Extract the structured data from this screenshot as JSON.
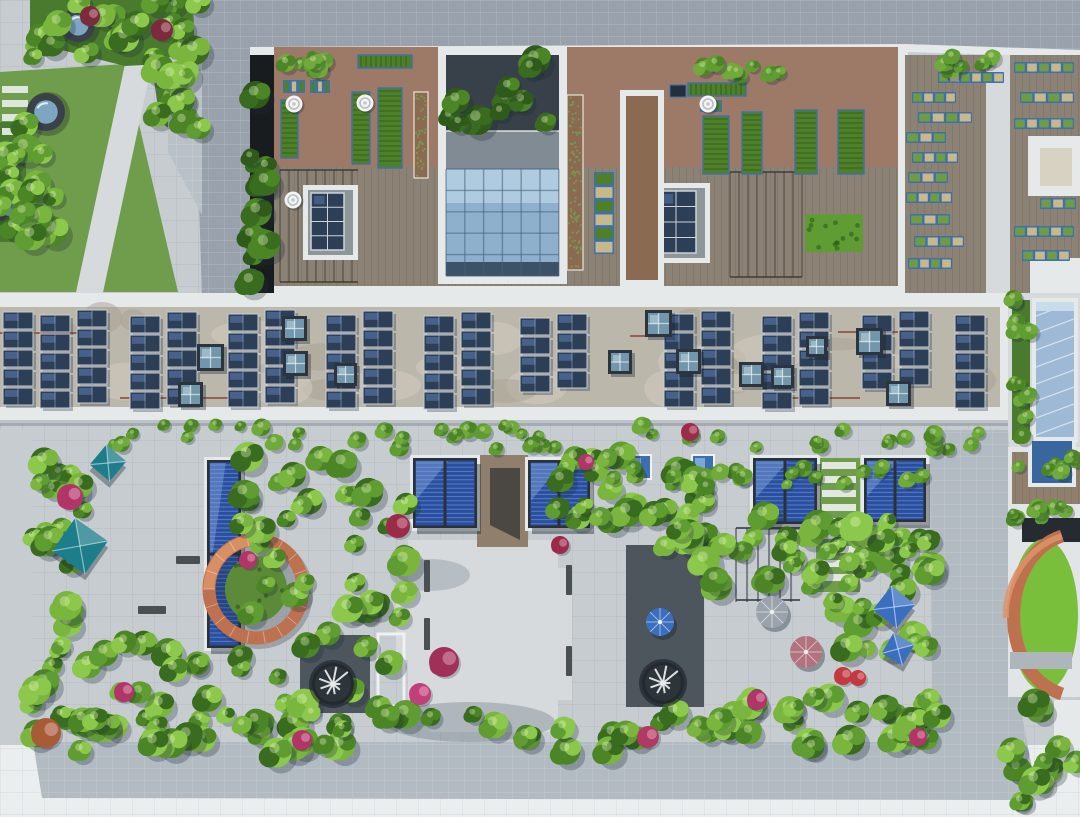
{
  "meta": {
    "title": "Aerial view of green rooftops",
    "description": "Top-down drone photograph of building rooftops with a lawn courtyard, rooftop vegetable farm, glass atrium, a long solar-panel roof and a lush landscaped roof garden with blue glass pergolas, copper ring walls, spiral stairs and umbrellas.",
    "image_type": "aerial-photograph"
  },
  "palette": {
    "paving": "#c7ccd1",
    "paving_light": "#d6dadd",
    "paving_white": "#ebeeef",
    "roof_gray": "#99a2ac",
    "roof_gray_light": "#b9c0c7",
    "roof_band": "#b2bac2",
    "parapet": "#e6e9ea",
    "lightwell_dark": "#191c1f",
    "pocket_dark": "#4d555d",
    "concrete": "#bcb7ab",
    "concrete_light": "#d2cdc0",
    "solar_dark": "#2d3e57",
    "solar_sheen": "#4a6590",
    "skylight_frame": "#2c343d",
    "skylight_glass": "#7296ab",
    "skylight_glass_light": "#a3c0cd",
    "atrium_dark": "#38414a",
    "slab_gray": "#818b94",
    "glass_blue": "#8fb0cd",
    "glass_blue_light": "#aecbe0",
    "glass_deep": "#3c5268",
    "pergola_blue": "#2b4f9f",
    "pergola_louver": "#6f94d8",
    "pergola_glare": "#87a8e0",
    "pergola_frame": "#2a3138",
    "lawn": "#6f9d4b",
    "grass_ring": "#5d8a38",
    "grass_bright": "#79bf3c",
    "foliage_base": "#4a7a2e",
    "soil_paver": "#9c7a67",
    "soil": "#8a6a50",
    "deck": "#8b8174",
    "deck_brown": "#8f7f6c",
    "planter_blue": "#3e6fae",
    "crop_green": "#4d8029",
    "pallet_tan": "#c9b98a",
    "copper": "#bd714e",
    "copper_light": "#dd9468",
    "teal_umbrella": "#1d7d8a",
    "blue_umbrella": "#3a6fc0",
    "mauve_umbrella": "#b2737f",
    "gray_umbrella": "#9aa3ab",
    "pipe_red": "#8f4a3c",
    "bench_dark": "#4a4f52",
    "shadow": "rgba(28,42,58,0.28)"
  },
  "scene": {
    "top_left": {
      "circular_skylights": [
        {
          "x": 78,
          "y": 25,
          "r": 17
        },
        {
          "x": 46,
          "y": 112,
          "r": 19
        },
        {
          "x": 10,
          "y": 205,
          "r": 18
        }
      ],
      "stepping_stones": {
        "x": 2,
        "y": 86,
        "w": 26,
        "h": 7,
        "gap": 14,
        "count": 5
      }
    },
    "farm": {
      "beds": [
        {
          "x": 358,
          "y": 55,
          "w": 54,
          "h": 13,
          "kind": "crop"
        },
        {
          "x": 283,
          "y": 80,
          "w": 22,
          "h": 13,
          "kind": "pallet"
        },
        {
          "x": 310,
          "y": 80,
          "w": 20,
          "h": 13,
          "kind": "pallet"
        },
        {
          "x": 281,
          "y": 100,
          "w": 17,
          "h": 58,
          "kind": "crop"
        },
        {
          "x": 352,
          "y": 92,
          "w": 18,
          "h": 72,
          "kind": "crop"
        },
        {
          "x": 378,
          "y": 88,
          "w": 24,
          "h": 80,
          "kind": "crop"
        },
        {
          "x": 414,
          "y": 92,
          "w": 14,
          "h": 86,
          "kind": "soil"
        },
        {
          "x": 567,
          "y": 95,
          "w": 16,
          "h": 175,
          "kind": "soil"
        },
        {
          "x": 594,
          "y": 172,
          "w": 20,
          "h": 82,
          "kind": "pallet"
        },
        {
          "x": 688,
          "y": 83,
          "w": 58,
          "h": 13,
          "kind": "crop"
        },
        {
          "x": 670,
          "y": 85,
          "w": 16,
          "h": 12,
          "kind": "dark"
        },
        {
          "x": 700,
          "y": 100,
          "w": 22,
          "h": 12,
          "kind": "pallet"
        },
        {
          "x": 703,
          "y": 116,
          "w": 26,
          "h": 58,
          "kind": "crop"
        },
        {
          "x": 742,
          "y": 112,
          "w": 20,
          "h": 62,
          "kind": "crop"
        },
        {
          "x": 795,
          "y": 110,
          "w": 22,
          "h": 64,
          "kind": "crop"
        },
        {
          "x": 838,
          "y": 110,
          "w": 26,
          "h": 64,
          "kind": "crop"
        },
        {
          "x": 805,
          "y": 214,
          "w": 58,
          "h": 38,
          "kind": "hedge"
        }
      ],
      "vents": [
        {
          "x": 294,
          "y": 104
        },
        {
          "x": 293,
          "y": 200
        },
        {
          "x": 365,
          "y": 103
        },
        {
          "x": 630,
          "y": 103
        },
        {
          "x": 708,
          "y": 104
        }
      ],
      "solar_units": [
        {
          "x": 303,
          "y": 185,
          "w": 55,
          "h": 75
        },
        {
          "x": 648,
          "y": 183,
          "w": 62,
          "h": 80
        }
      ],
      "trellis": [
        {
          "x": 280,
          "y": 170,
          "w": 78,
          "h": 112
        },
        {
          "x": 730,
          "y": 172,
          "w": 72,
          "h": 105
        }
      ]
    },
    "right_deck": {
      "planter_rows": [
        {
          "x": 938,
          "y": 72,
          "w": 66,
          "h": 11
        },
        {
          "x": 912,
          "y": 92,
          "w": 44,
          "h": 11
        },
        {
          "x": 918,
          "y": 112,
          "w": 54,
          "h": 11
        },
        {
          "x": 906,
          "y": 132,
          "w": 40,
          "h": 11
        },
        {
          "x": 912,
          "y": 152,
          "w": 46,
          "h": 11
        },
        {
          "x": 908,
          "y": 172,
          "w": 40,
          "h": 11
        },
        {
          "x": 906,
          "y": 192,
          "w": 46,
          "h": 11
        },
        {
          "x": 910,
          "y": 214,
          "w": 40,
          "h": 11
        },
        {
          "x": 914,
          "y": 236,
          "w": 50,
          "h": 11
        },
        {
          "x": 908,
          "y": 258,
          "w": 44,
          "h": 11
        },
        {
          "x": 1014,
          "y": 62,
          "w": 60,
          "h": 11
        },
        {
          "x": 1020,
          "y": 92,
          "w": 54,
          "h": 11
        },
        {
          "x": 1014,
          "y": 118,
          "w": 60,
          "h": 11
        },
        {
          "x": 1040,
          "y": 198,
          "w": 36,
          "h": 11
        },
        {
          "x": 1014,
          "y": 226,
          "w": 60,
          "h": 11
        },
        {
          "x": 1022,
          "y": 250,
          "w": 48,
          "h": 11
        }
      ]
    },
    "solar_roof": {
      "panel": {
        "w": 30,
        "h": 17,
        "gap": 2
      },
      "columns": [
        {
          "x": 3,
          "y": 312,
          "n": 5
        },
        {
          "x": 40,
          "y": 315,
          "n": 5
        },
        {
          "x": 77,
          "y": 310,
          "n": 5
        },
        {
          "x": 130,
          "y": 316,
          "n": 5
        },
        {
          "x": 167,
          "y": 312,
          "n": 5
        },
        {
          "x": 228,
          "y": 314,
          "n": 5
        },
        {
          "x": 265,
          "y": 310,
          "n": 5
        },
        {
          "x": 326,
          "y": 315,
          "n": 5
        },
        {
          "x": 363,
          "y": 311,
          "n": 5
        },
        {
          "x": 424,
          "y": 316,
          "n": 5
        },
        {
          "x": 461,
          "y": 312,
          "n": 5
        },
        {
          "x": 520,
          "y": 318,
          "n": 4
        },
        {
          "x": 557,
          "y": 314,
          "n": 4
        },
        {
          "x": 664,
          "y": 314,
          "n": 5
        },
        {
          "x": 701,
          "y": 311,
          "n": 5
        },
        {
          "x": 762,
          "y": 316,
          "n": 5
        },
        {
          "x": 799,
          "y": 312,
          "n": 5
        },
        {
          "x": 862,
          "y": 315,
          "n": 4
        },
        {
          "x": 899,
          "y": 311,
          "n": 4
        },
        {
          "x": 955,
          "y": 315,
          "n": 5
        }
      ],
      "skylights": [
        {
          "x": 197,
          "y": 344,
          "s": 27
        },
        {
          "x": 178,
          "y": 382,
          "s": 25
        },
        {
          "x": 282,
          "y": 316,
          "s": 25
        },
        {
          "x": 283,
          "y": 351,
          "s": 25
        },
        {
          "x": 334,
          "y": 363,
          "s": 23
        },
        {
          "x": 608,
          "y": 350,
          "s": 24
        },
        {
          "x": 645,
          "y": 310,
          "s": 27
        },
        {
          "x": 676,
          "y": 349,
          "s": 25
        },
        {
          "x": 739,
          "y": 362,
          "s": 25
        },
        {
          "x": 771,
          "y": 365,
          "s": 23
        },
        {
          "x": 806,
          "y": 336,
          "s": 21
        },
        {
          "x": 856,
          "y": 328,
          "s": 27
        },
        {
          "x": 886,
          "y": 381,
          "s": 25
        }
      ],
      "pipes": [
        {
          "x1": 0,
          "y": 333,
          "x2": 95
        },
        {
          "x1": 120,
          "y": 398,
          "x2": 230
        },
        {
          "x1": 630,
          "y": 336,
          "x2": 690
        },
        {
          "x1": 790,
          "y": 398,
          "x2": 860
        },
        {
          "x1": 838,
          "y": 332,
          "x2": 898
        }
      ]
    },
    "garden": {
      "pergolas": [
        {
          "x": 413,
          "y": 458,
          "w": 64,
          "h": 70
        },
        {
          "x": 528,
          "y": 460,
          "w": 62,
          "h": 68
        },
        {
          "x": 753,
          "y": 458,
          "w": 64,
          "h": 66
        },
        {
          "x": 864,
          "y": 458,
          "w": 62,
          "h": 64
        },
        {
          "x": 207,
          "y": 460,
          "w": 34,
          "h": 188,
          "vert": true
        }
      ],
      "copper_ring": {
        "cx": 256,
        "cy": 589,
        "rx": 47,
        "ry": 49,
        "inner_rx": 31,
        "inner_ry": 33
      },
      "spiral_stairs": [
        {
          "x": 333,
          "y": 684,
          "r": 21
        },
        {
          "x": 663,
          "y": 683,
          "r": 21
        }
      ],
      "small_skylights": [
        {
          "x": 628,
          "y": 456,
          "s": 22
        },
        {
          "x": 693,
          "y": 456,
          "s": 20
        }
      ],
      "umbrellas": [
        {
          "x": 108,
          "y": 463,
          "size": 26,
          "shape": "square",
          "rot": 40,
          "color": "teal_umbrella"
        },
        {
          "x": 80,
          "y": 546,
          "size": 40,
          "shape": "square",
          "rot": 35,
          "color": "teal_umbrella"
        },
        {
          "x": 772,
          "y": 612,
          "size": 16,
          "shape": "round",
          "rot": 0,
          "color": "gray_umbrella"
        },
        {
          "x": 806,
          "y": 652,
          "size": 16,
          "shape": "round",
          "rot": 0,
          "color": "mauve_umbrella"
        },
        {
          "x": 894,
          "y": 607,
          "size": 30,
          "shape": "square",
          "rot": 38,
          "color": "blue_umbrella"
        },
        {
          "x": 898,
          "y": 649,
          "size": 24,
          "shape": "square",
          "rot": 30,
          "color": "blue_umbrella"
        },
        {
          "x": 660,
          "y": 622,
          "size": 14,
          "shape": "round",
          "rot": 0,
          "color": "blue_umbrella"
        }
      ],
      "benches": [
        {
          "x": 424,
          "y": 560,
          "w": 6,
          "h": 32
        },
        {
          "x": 424,
          "y": 618,
          "w": 6,
          "h": 32
        },
        {
          "x": 566,
          "y": 565,
          "w": 6,
          "h": 30
        },
        {
          "x": 566,
          "y": 646,
          "w": 6,
          "h": 30
        },
        {
          "x": 138,
          "y": 606,
          "w": 28,
          "h": 8
        },
        {
          "x": 176,
          "y": 556,
          "w": 24,
          "h": 8
        }
      ],
      "stepping_stones": {
        "x": 822,
        "y": 462,
        "w": 34,
        "h": 7,
        "gap": 14,
        "count": 9
      }
    },
    "vegetation_strips": [
      {
        "x": 32,
        "y": 0,
        "w": 168,
        "h": 62,
        "n": 22,
        "type": "mix"
      },
      {
        "x": 155,
        "y": 62,
        "w": 48,
        "h": 70,
        "n": 10,
        "type": "mix"
      },
      {
        "x": 0,
        "y": 122,
        "w": 26,
        "h": 118,
        "n": 10,
        "type": "mix"
      },
      {
        "x": 0,
        "y": 128,
        "w": 60,
        "h": 120,
        "n": 8,
        "type": "mix"
      },
      {
        "x": 250,
        "y": 70,
        "w": 22,
        "h": 220,
        "n": 12,
        "type": "dark"
      },
      {
        "x": 448,
        "y": 57,
        "w": 108,
        "h": 70,
        "n": 12,
        "type": "dark"
      },
      {
        "x": 938,
        "y": 56,
        "w": 68,
        "h": 14,
        "n": 8,
        "type": "hedge"
      },
      {
        "x": 276,
        "y": 56,
        "w": 60,
        "h": 18,
        "n": 8,
        "type": "hedge"
      },
      {
        "x": 700,
        "y": 62,
        "w": 80,
        "h": 16,
        "n": 8,
        "type": "hedge"
      },
      {
        "x": 1010,
        "y": 298,
        "w": 20,
        "h": 138,
        "n": 12,
        "type": "hedge"
      },
      {
        "x": 95,
        "y": 424,
        "w": 905,
        "h": 26,
        "n": 48,
        "type": "hedge"
      },
      {
        "x": 30,
        "y": 452,
        "w": 62,
        "h": 285,
        "n": 30,
        "type": "mix"
      },
      {
        "x": 85,
        "y": 635,
        "w": 125,
        "h": 105,
        "n": 20,
        "type": "mix"
      },
      {
        "x": 240,
        "y": 452,
        "w": 168,
        "h": 290,
        "n": 52,
        "type": "mix"
      },
      {
        "x": 556,
        "y": 452,
        "w": 90,
        "h": 100,
        "n": 16,
        "type": "mix"
      },
      {
        "x": 640,
        "y": 452,
        "w": 70,
        "h": 95,
        "n": 14,
        "type": "mix"
      },
      {
        "x": 698,
        "y": 515,
        "w": 235,
        "h": 75,
        "n": 30,
        "type": "mix"
      },
      {
        "x": 635,
        "y": 695,
        "w": 300,
        "h": 52,
        "n": 26,
        "type": "mix"
      },
      {
        "x": 825,
        "y": 525,
        "w": 108,
        "h": 125,
        "n": 22,
        "type": "mix"
      },
      {
        "x": 590,
        "y": 466,
        "w": 335,
        "h": 22,
        "n": 22,
        "type": "hedge"
      },
      {
        "x": 60,
        "y": 712,
        "w": 880,
        "h": 42,
        "n": 40,
        "type": "mix"
      },
      {
        "x": 1012,
        "y": 498,
        "w": 68,
        "h": 22,
        "n": 10,
        "type": "hedge"
      },
      {
        "x": 1012,
        "y": 455,
        "w": 68,
        "h": 18,
        "n": 8,
        "type": "hedge"
      },
      {
        "x": 1008,
        "y": 700,
        "w": 72,
        "h": 105,
        "n": 14,
        "type": "mix"
      }
    ],
    "flowers": [
      {
        "x": 90,
        "y": 16,
        "r": 10,
        "color": "#7c2b3d"
      },
      {
        "x": 162,
        "y": 30,
        "r": 11,
        "color": "#7c2b3d"
      },
      {
        "x": 70,
        "y": 497,
        "r": 13,
        "color": "#b13566"
      },
      {
        "x": 46,
        "y": 733,
        "r": 15,
        "color": "#a85c36"
      },
      {
        "x": 124,
        "y": 692,
        "r": 10,
        "color": "#b13566"
      },
      {
        "x": 248,
        "y": 560,
        "r": 9,
        "color": "#b13566"
      },
      {
        "x": 398,
        "y": 526,
        "r": 12,
        "color": "#9c2b4a"
      },
      {
        "x": 444,
        "y": 662,
        "r": 15,
        "color": "#a03058"
      },
      {
        "x": 420,
        "y": 694,
        "r": 11,
        "color": "#c2407a"
      },
      {
        "x": 560,
        "y": 545,
        "r": 9,
        "color": "#9c2b4a"
      },
      {
        "x": 648,
        "y": 737,
        "r": 11,
        "color": "#b03a64"
      },
      {
        "x": 757,
        "y": 700,
        "r": 10,
        "color": "#b13566"
      },
      {
        "x": 843,
        "y": 676,
        "r": 9,
        "color": "#c23a3f"
      },
      {
        "x": 858,
        "y": 678,
        "r": 8,
        "color": "#c23a3f"
      },
      {
        "x": 918,
        "y": 737,
        "r": 9,
        "color": "#b13566"
      },
      {
        "x": 586,
        "y": 462,
        "r": 8,
        "color": "#b13566"
      },
      {
        "x": 302,
        "y": 740,
        "r": 10,
        "color": "#b13566"
      },
      {
        "x": 690,
        "y": 432,
        "r": 9,
        "color": "#9c2b4a"
      }
    ]
  }
}
